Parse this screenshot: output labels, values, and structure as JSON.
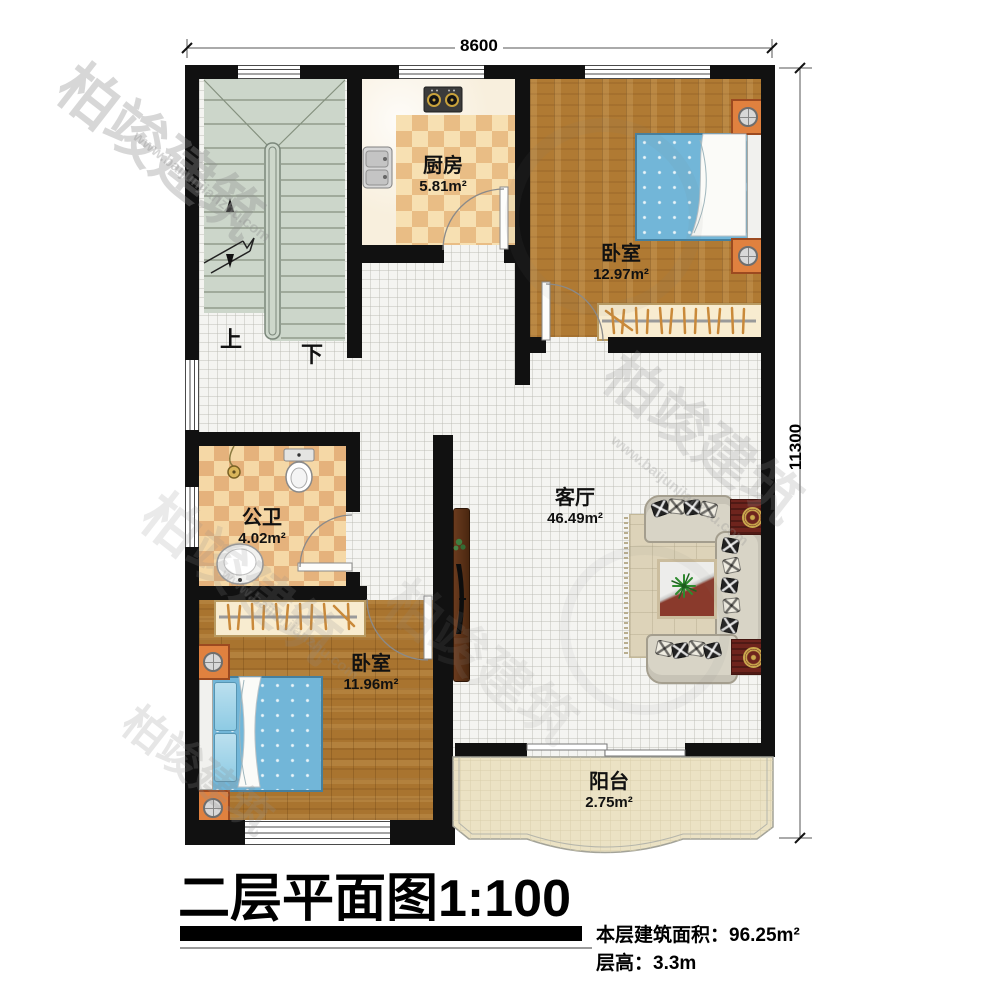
{
  "page": {
    "width": 1000,
    "height": 990,
    "background": "#ffffff"
  },
  "dimensions": {
    "top": "8600",
    "right": "11300"
  },
  "rooms": {
    "kitchen": {
      "name": "厨房",
      "area": "5.81m²"
    },
    "bedroom_top": {
      "name": "卧室",
      "area": "12.97m²"
    },
    "bathroom": {
      "name": "公卫",
      "area": "4.02m²"
    },
    "bedroom_bottom": {
      "name": "卧室",
      "area": "11.96m²"
    },
    "living": {
      "name": "客厅",
      "area": "46.49m²"
    },
    "balcony": {
      "name": "阳台",
      "area": "2.75m²"
    }
  },
  "stairs": {
    "up": "上",
    "down": "下"
  },
  "title_block": {
    "title": "二层平面图",
    "scale": "1:100",
    "area_line": "本层建筑面积：96.25m²",
    "floor_height_line": "层高：3.3m"
  },
  "watermark": {
    "brand": "柏竣建筑",
    "url": "www.baijunjianzhu.com"
  },
  "colors": {
    "wall": "#111111",
    "stair": "#ccd6ca",
    "wood": "#b07a33",
    "tile": "#f4f4f1",
    "checker_dark": "#e9bd85",
    "checker_light": "#f7e0b2",
    "bed_blue": "#72b6d8",
    "nightstand_orange": "#e0813f",
    "sofa_gray": "#d8d4c6",
    "rug_tan": "#ddd3b9",
    "side_table_red": "#6e241d",
    "balcony_beige": "#ebe2c4",
    "window_white": "#ffffff"
  }
}
